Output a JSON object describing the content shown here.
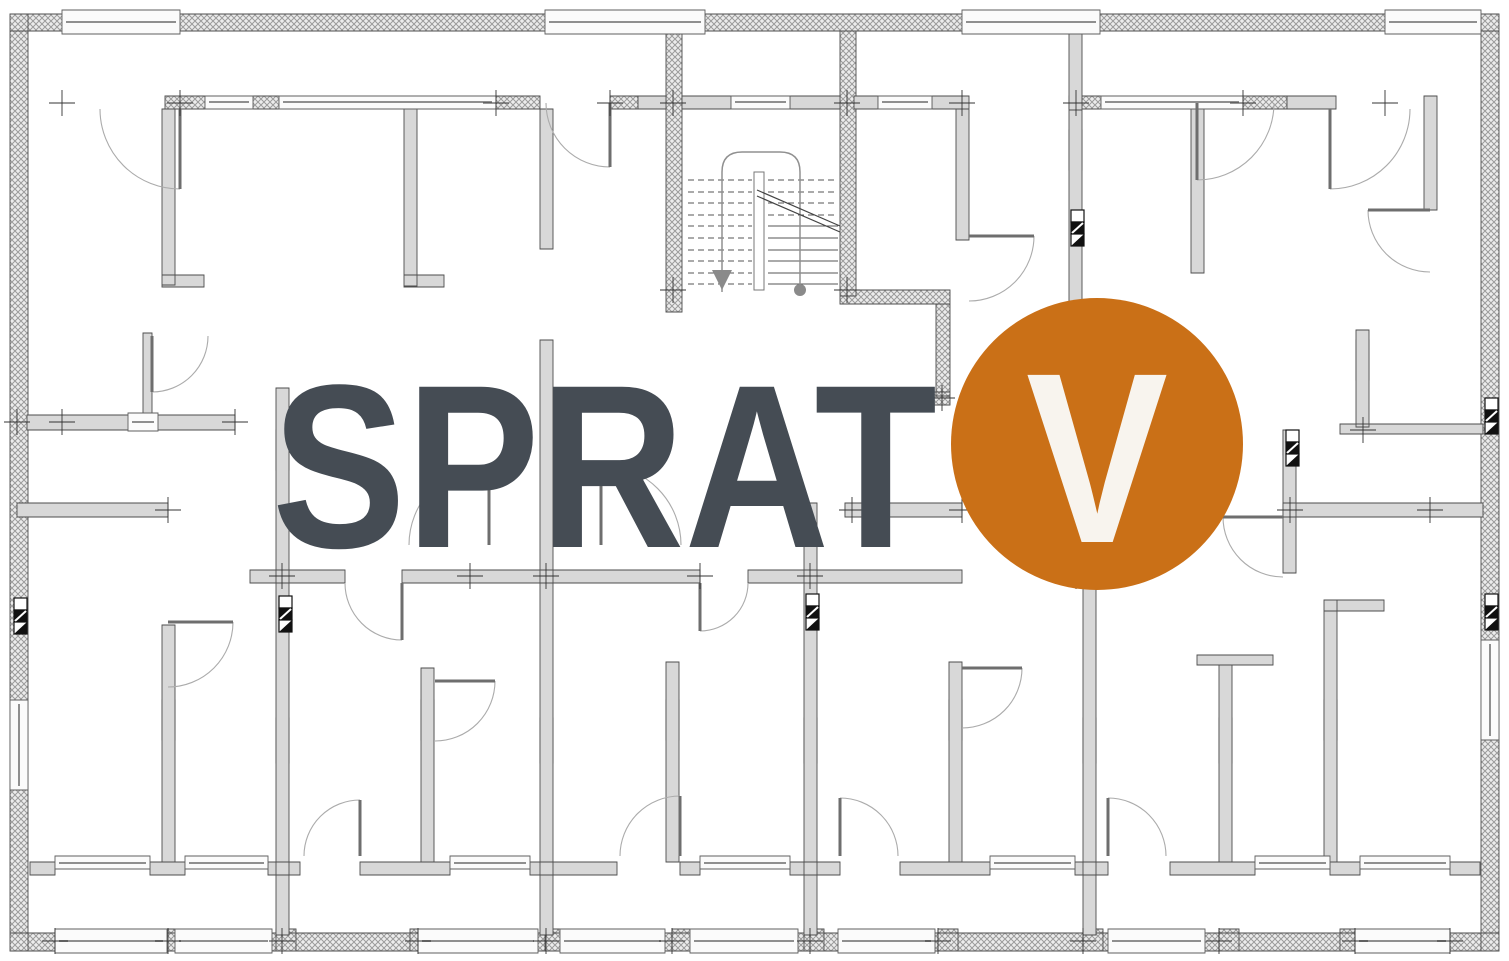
{
  "overlay": {
    "title": "SPRAT",
    "floor_label": "V",
    "title_color": "#454c54",
    "badge_color": "#ca7017",
    "badge_text_color": "#f8f4ee"
  },
  "plan": {
    "background": "#ffffff",
    "wall_fill": "#d8d8d8",
    "hatch_line": "#9b9b9b",
    "outline": "#4d4d4d",
    "door_arc": "#ababab"
  }
}
